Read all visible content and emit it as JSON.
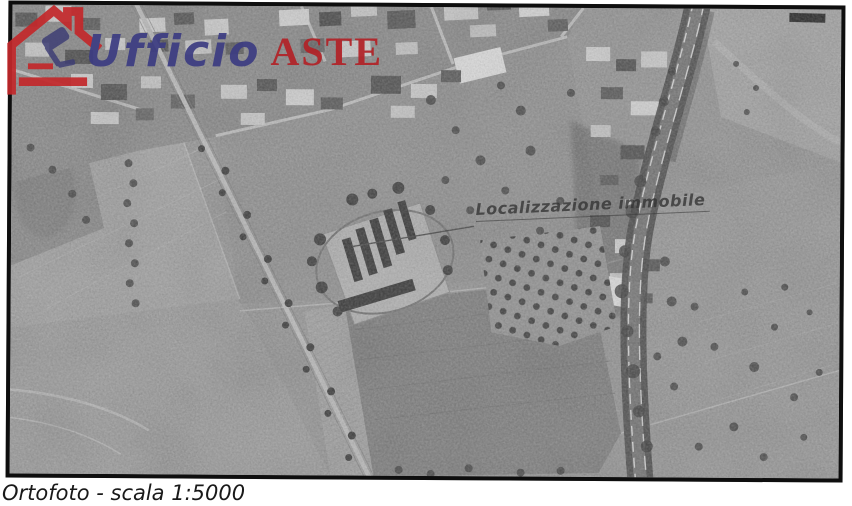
{
  "logo": {
    "word1": "Ufficio",
    "word2": "ASTE",
    "house_color": "#c3282b",
    "word1_color": "#3c3c82",
    "word2_color": "#b22227"
  },
  "map": {
    "annotation": "Localizzazione immobile"
  },
  "caption": "Ortofoto - scala 1:5000"
}
